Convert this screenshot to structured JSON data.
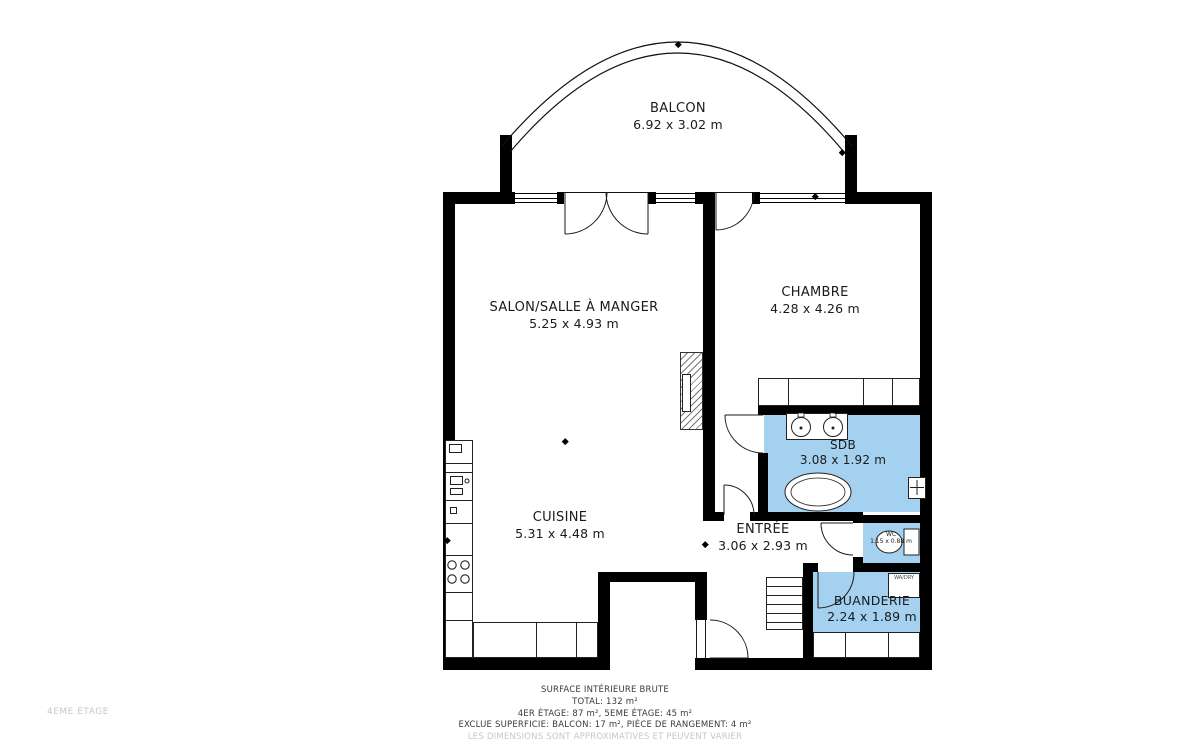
{
  "title": "Plan d'appartement - 4EME ÉTAGE",
  "floor_label": "4EME ÉTAGE",
  "colors": {
    "wall": "#000000",
    "room_fill": "#a4d1ef",
    "muted_text": "#c7c7c7"
  },
  "rooms": {
    "balcon": {
      "name": "BALCON",
      "dims": "6.92 x 3.02 m"
    },
    "salon": {
      "name": "SALON/SALLE À MANGER",
      "dims": "5.25 x 4.93 m"
    },
    "chambre": {
      "name": "CHAMBRE",
      "dims": "4.28 x 4.26 m"
    },
    "sdb": {
      "name": "SDB",
      "dims": "3.08 x 1.92 m"
    },
    "cuisine": {
      "name": "CUISINE",
      "dims": "5.31 x 4.48 m"
    },
    "entree": {
      "name": "ENTRÉE",
      "dims": "3.06 x 2.93 m"
    },
    "wc": {
      "name": "WC",
      "dims": "1.15 x 0.88 m"
    },
    "buanderie": {
      "name": "BUANDERIE",
      "dims": "2.24 x 1.89 m"
    }
  },
  "appliance_labels": {
    "washer_dryer": "WA/DRY"
  },
  "footer": {
    "lines": [
      "SURFACE INTÉRIEURE BRUTE",
      "TOTAL: 132 m²",
      "4ER ÉTAGE: 87 m², 5EME ÉTAGE: 45 m²",
      "EXCLUE SUPERFICIE: BALCON: 17 m², PIÈCE DE RANGEMENT: 4 m²",
      "LES DIMENSIONS SONT APPROXIMATIVES ET PEUVENT VARIER"
    ]
  }
}
